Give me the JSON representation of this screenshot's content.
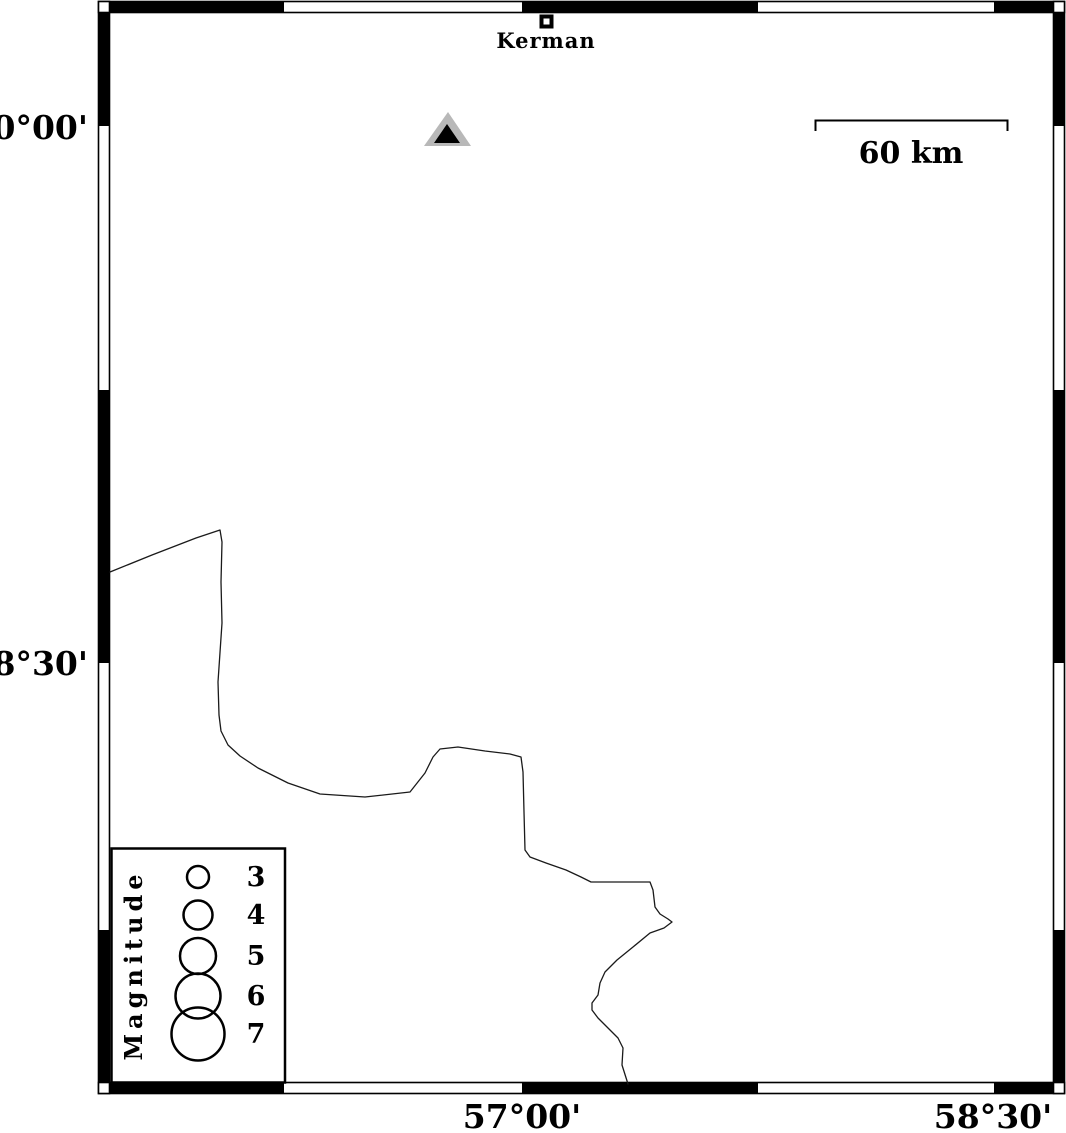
{
  "map": {
    "type": "seismicity-map",
    "background": "#ffffff",
    "frame_color": "#000000"
  },
  "axes": {
    "lat": [
      {
        "label": "30°00'"
      },
      {
        "label": "28°30'"
      }
    ],
    "lon": [
      {
        "label": "57°00'"
      },
      {
        "label": "58°30'"
      }
    ]
  },
  "city": {
    "name": "Kerman",
    "marker": "open-square"
  },
  "station": {
    "marker": "triangle",
    "outer_fill": "#b8b8b8",
    "inner_fill": "#000000"
  },
  "scale_bar": {
    "label": "60 km",
    "length_km": 60
  },
  "legend": {
    "title": "Magnitude",
    "entries": [
      {
        "magnitude": "3",
        "radius_px": 11
      },
      {
        "magnitude": "4",
        "radius_px": 14.5
      },
      {
        "magnitude": "5",
        "radius_px": 18
      },
      {
        "magnitude": "6",
        "radius_px": 22.5
      },
      {
        "magnitude": "7",
        "radius_px": 26.5
      }
    ]
  },
  "coastline": {
    "color": "#1a1a1a",
    "points": "110,572 152,555 196,538 220,530 222,542 221,582 222,623 218,682 219,715 221,731 228,745 240,756 258,768 288,783 320,794 365,797 410,792 425,773 433,757 440,749 458,747 485,751 510,754 521,757 523,772 524,812 525,850 530,857 546,863 566,870 581,877 591,882 650,882 653,890 655,907 660,914 668,919 672,922 664,928 650,933 633,947 617,960 605,972 600,983 598,995 592,1003 592,1010 598,1018 607,1027 618,1038 623,1048 622,1065 628,1084"
  }
}
